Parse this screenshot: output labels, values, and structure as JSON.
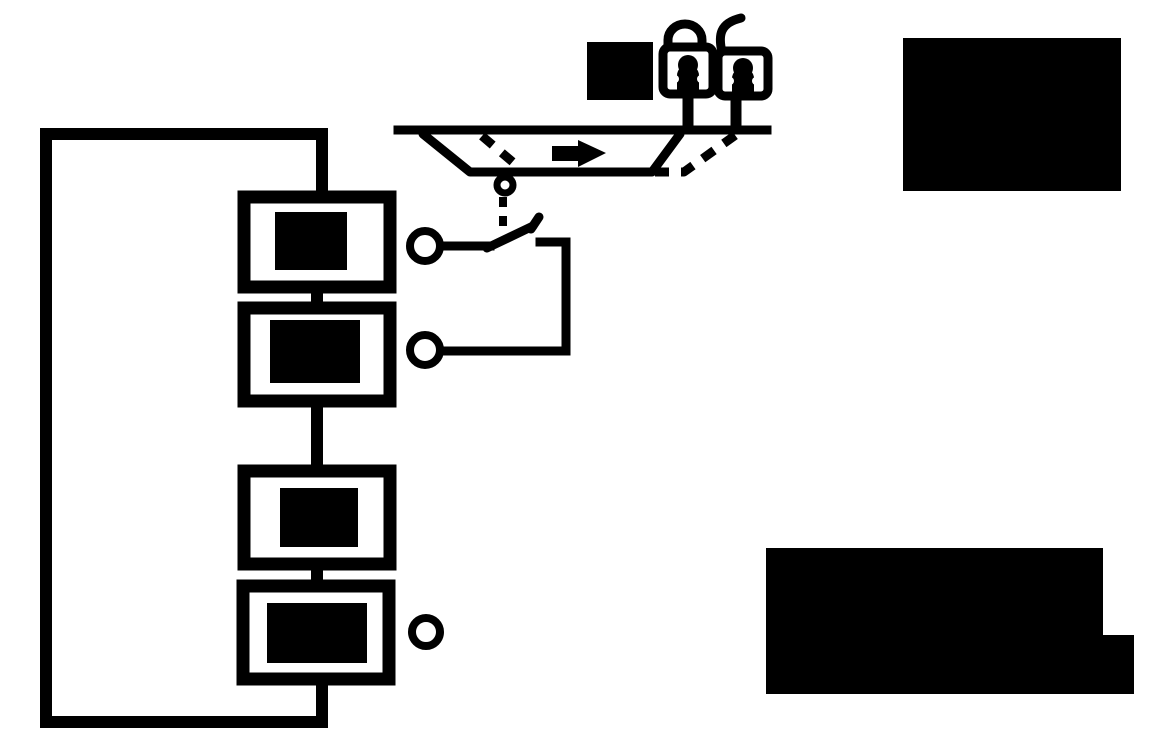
{
  "colors": {
    "ink": "#000000",
    "paper": "#ffffff"
  },
  "diagram": {
    "type": "black-and-white schematic with redacted labels",
    "icons": {
      "lamp_left": "locked-indicator-icon",
      "lamp_right": "corded-indicator-icon",
      "direction_arrow": "arrow-right-icon",
      "carriage": "trapezoid-carriage",
      "switch": "normally-open-contact-switch"
    },
    "redacted_labels": [
      "device-box-1-label",
      "device-box-2-label",
      "device-box-3-label",
      "device-box-4-label",
      "carriage-area-label",
      "legend-block-top-right",
      "caption-block-bottom-right"
    ],
    "terminals": {
      "count": 3
    },
    "device_boxes": {
      "count": 4
    }
  }
}
